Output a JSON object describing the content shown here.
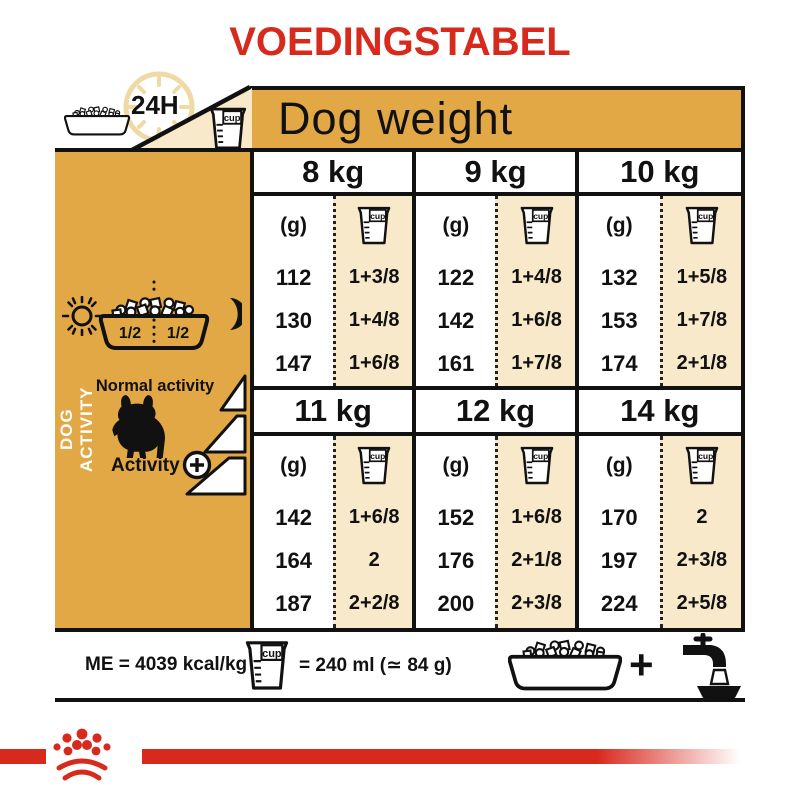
{
  "title": "VOEDINGSTABEL",
  "colors": {
    "red": "#D8291D",
    "gold": "#E2A845",
    "cream": "#F8E9CA",
    "ink": "#111111"
  },
  "header": {
    "h24": "24H"
  },
  "labels": {
    "cup": "cup",
    "half": "1/2"
  },
  "sidebar": {
    "vertical": "DOG ACTIVITY",
    "normal": "Normal activity",
    "activity": "Activity"
  },
  "footer": {
    "me": "ME = 4039 kcal/kg",
    "equiv": "= 240 ml (≃ 84 g)",
    "plus": "+"
  },
  "chart_data": {
    "type": "table",
    "title": "VOEDINGSTABEL",
    "header": "Dog weight",
    "units": {
      "amount": "(g)",
      "measure": "cup"
    },
    "notes": {
      "energy": "ME = 4039 kcal/kg",
      "cup_volume": "= 240 ml (≃ 84 g)",
      "ration_split": "1/2 + 1/2 per 24H"
    },
    "activity_levels": [
      "Normal activity",
      "Activity +"
    ],
    "columns": [
      {
        "weight": "8 kg",
        "grams": [
          "112",
          "130",
          "147"
        ],
        "cups": [
          "1+3/8",
          "1+4/8",
          "1+6/8"
        ]
      },
      {
        "weight": "9 kg",
        "grams": [
          "122",
          "142",
          "161"
        ],
        "cups": [
          "1+4/8",
          "1+6/8",
          "1+7/8"
        ]
      },
      {
        "weight": "10 kg",
        "grams": [
          "132",
          "153",
          "174"
        ],
        "cups": [
          "1+5/8",
          "1+7/8",
          "2+1/8"
        ]
      },
      {
        "weight": "11 kg",
        "grams": [
          "142",
          "164",
          "187"
        ],
        "cups": [
          "1+6/8",
          "2",
          "2+2/8"
        ]
      },
      {
        "weight": "12 kg",
        "grams": [
          "152",
          "176",
          "200"
        ],
        "cups": [
          "1+6/8",
          "2+1/8",
          "2+3/8"
        ]
      },
      {
        "weight": "14 kg",
        "grams": [
          "170",
          "197",
          "224"
        ],
        "cups": [
          "2",
          "2+3/8",
          "2+5/8"
        ]
      }
    ]
  }
}
